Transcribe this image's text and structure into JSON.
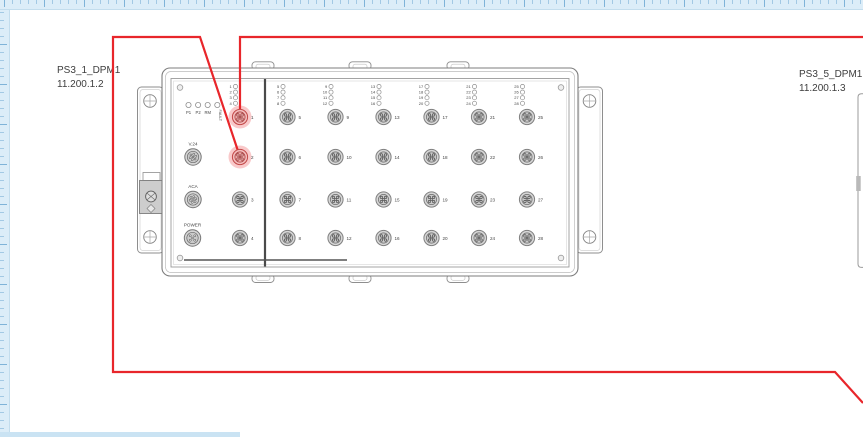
{
  "labels": {
    "device_left": {
      "name": "PS3_1_DPM1",
      "address": "11.200.1.2"
    },
    "device_right": {
      "name": "PS3_5_DPM1",
      "address": "11.200.1.3"
    }
  },
  "switch_panel": {
    "system_leds": [
      "P1",
      "P2",
      "RM",
      "FAULT"
    ],
    "aux_connectors": [
      "V.24",
      "ACA",
      "POWER"
    ],
    "port_numbers": [
      1,
      2,
      3,
      4,
      5,
      6,
      7,
      8,
      9,
      10,
      11,
      12,
      13,
      14,
      15,
      16,
      17,
      18,
      19,
      20,
      21,
      22,
      23,
      24,
      25,
      26,
      27,
      28
    ],
    "highlighted_ports": [
      1,
      2
    ],
    "led_group_size": 4
  },
  "connections": [
    {
      "id": "cable-to-port-1",
      "color": "#e8262b",
      "points": [
        [
          863,
          37
        ],
        [
          240,
          37
        ],
        [
          240,
          117
        ]
      ]
    },
    {
      "id": "cable-from-port-2",
      "color": "#e8262b",
      "points": [
        [
          240,
          157
        ],
        [
          200,
          37
        ],
        [
          113,
          37
        ],
        [
          113,
          372
        ],
        [
          835,
          372
        ],
        [
          863,
          403
        ]
      ]
    }
  ],
  "colors": {
    "cable": "#e8262b",
    "port_highlight_fill": "#f3bcbc",
    "port_highlight_halo": "rgba(232,38,43,0.25)",
    "ruler_background": "#dcedf8",
    "ruler_tick": "#7fb3d8"
  }
}
